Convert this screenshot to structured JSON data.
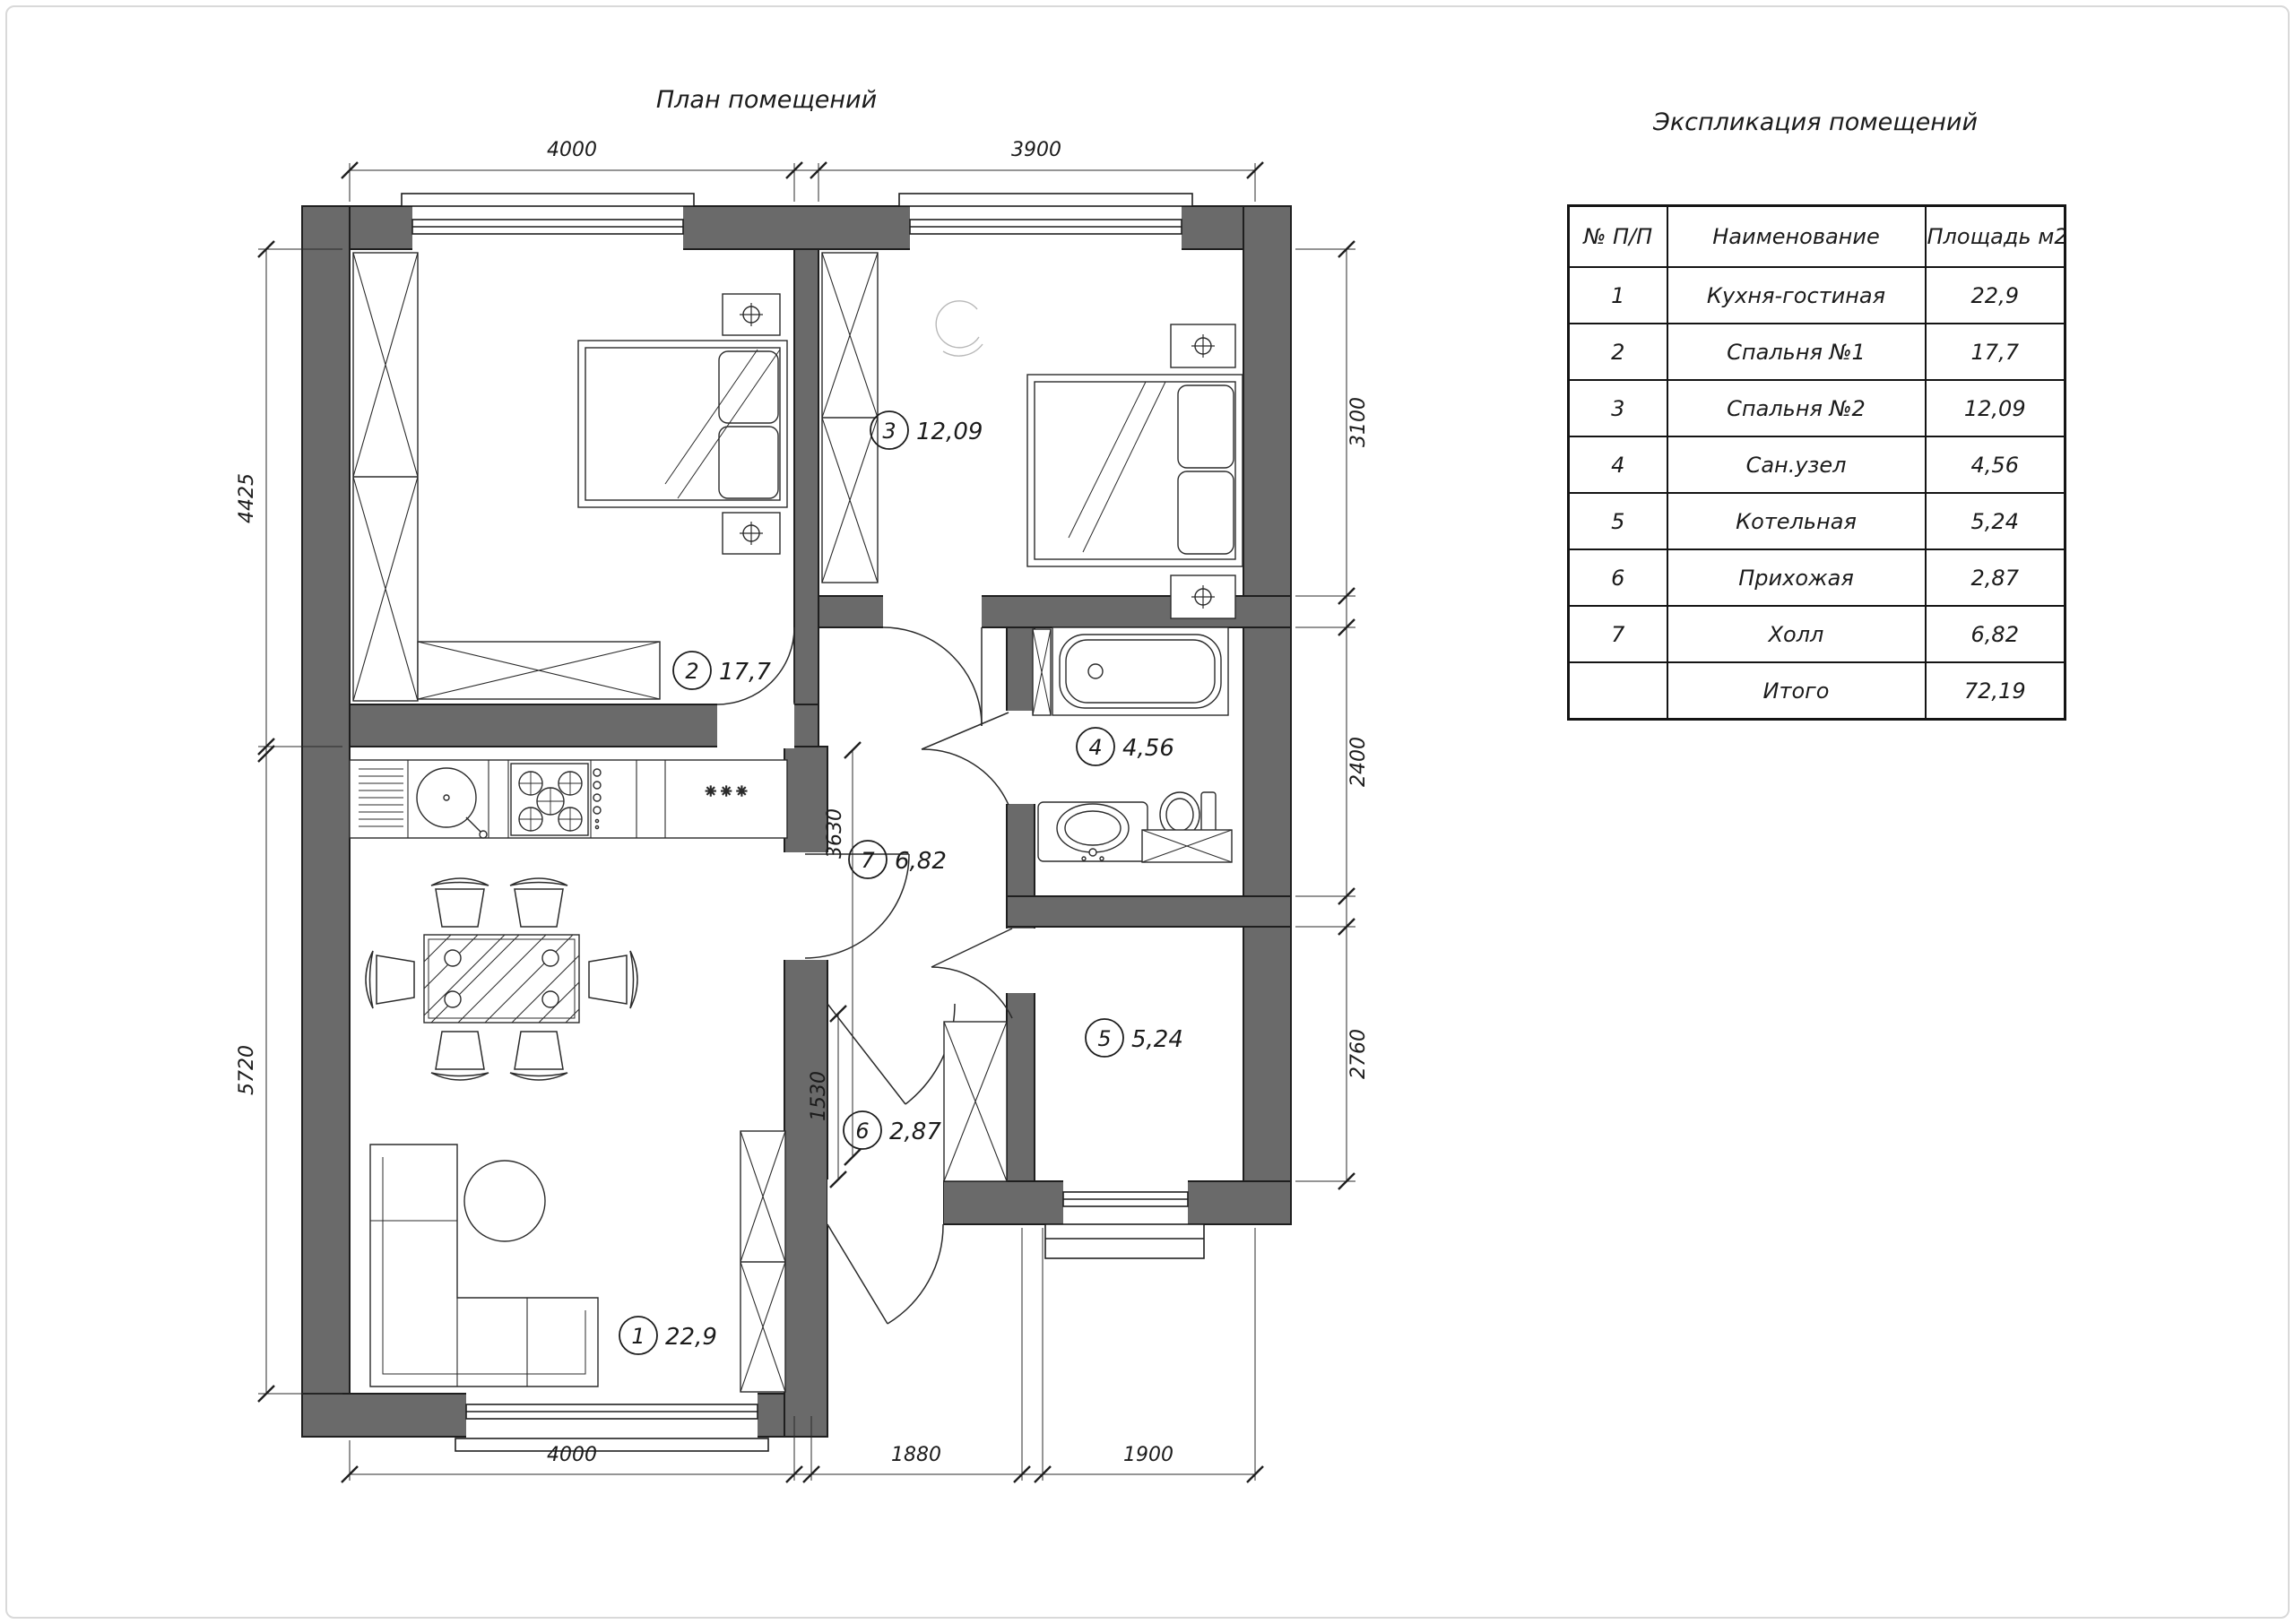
{
  "titles": {
    "plan": "План помещений",
    "table": "Экспликация помещений"
  },
  "table": {
    "headers": [
      "№ П/П",
      "Наименование",
      "Площадь м2"
    ],
    "rows": [
      [
        "1",
        "Кухня-гостиная",
        "22,9"
      ],
      [
        "2",
        "Спальня №1",
        "17,7"
      ],
      [
        "3",
        "Спальня №2",
        "12,09"
      ],
      [
        "4",
        "Сан.узел",
        "4,56"
      ],
      [
        "5",
        "Котельная",
        "5,24"
      ],
      [
        "6",
        "Прихожая",
        "2,87"
      ],
      [
        "7",
        "Холл",
        "6,82"
      ],
      [
        "",
        "Итого",
        "72,19"
      ]
    ]
  },
  "rooms": [
    {
      "num": "1",
      "area": "22,9"
    },
    {
      "num": "2",
      "area": "17,7"
    },
    {
      "num": "3",
      "area": "12,09"
    },
    {
      "num": "4",
      "area": "4,56"
    },
    {
      "num": "5",
      "area": "5,24"
    },
    {
      "num": "6",
      "area": "2,87"
    },
    {
      "num": "7",
      "area": "6,82"
    }
  ],
  "dims": {
    "top": [
      "4000",
      "3900"
    ],
    "bottom": [
      "4000",
      "1880",
      "1900"
    ],
    "left": [
      "4425",
      "5720"
    ],
    "right": [
      "3100",
      "2400",
      "2760"
    ],
    "inner": [
      "3630",
      "1530"
    ]
  },
  "symbols": {
    "freezer": "✳ ✳ ✳"
  },
  "colors": {
    "wall": "#6a6a6a",
    "line": "#1f1f1f",
    "background": "#ffffff"
  }
}
